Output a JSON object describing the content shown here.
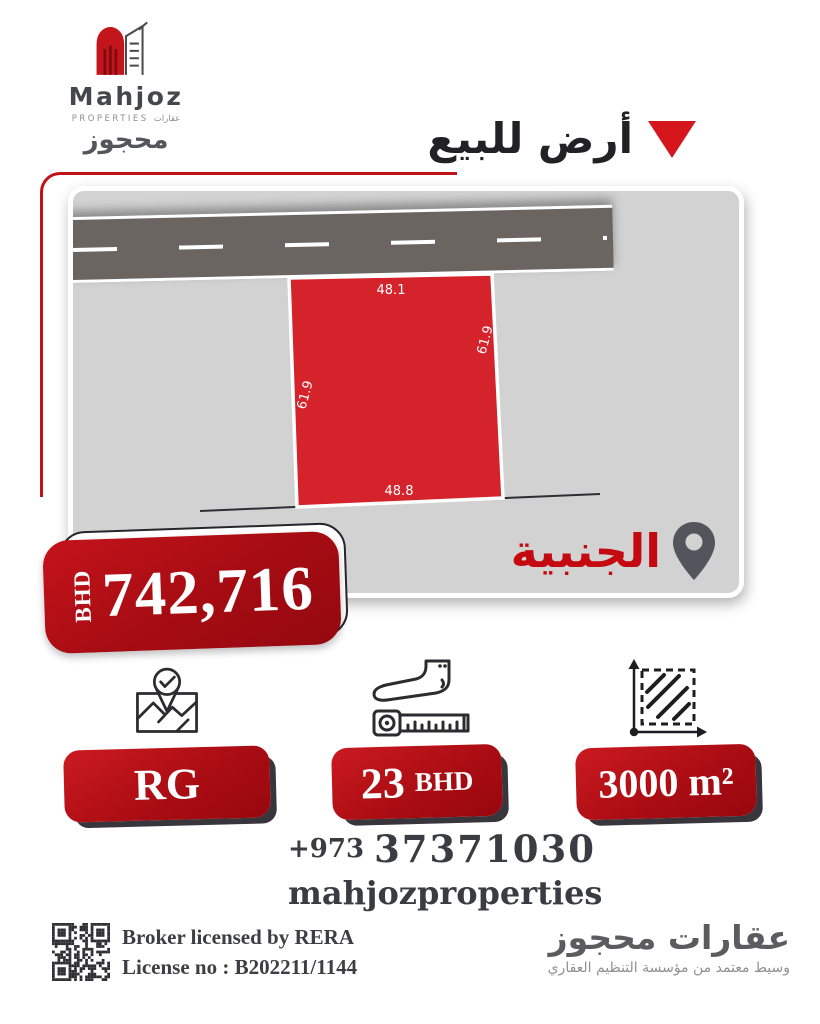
{
  "colors": {
    "accent_red": "#c1121a",
    "plot_red": "#d5232b",
    "badge_red": "#a80c12",
    "triangle_red": "#d5161d",
    "location_red": "#c40a10",
    "road_gray": "#6b6562",
    "card_gray": "#d2d2d2",
    "text_dark": "#3b3b42"
  },
  "logo": {
    "name": "Mahjoz",
    "sub_en": "PROPERTIES",
    "sub_ar": "عقارات",
    "arabic": "محجوز"
  },
  "title": {
    "text": "أرض للبيع"
  },
  "map": {
    "location": "الجنبية",
    "dimensions": {
      "top": "48.1",
      "bottom": "48.8",
      "left": "61.9",
      "right": "61.9"
    }
  },
  "price": {
    "currency": "BHD",
    "amount": "742,716"
  },
  "features": [
    {
      "icon": "map-check-icon",
      "label": "RG"
    },
    {
      "icon": "foot-measure-icon",
      "value": "23",
      "unit": "BHD"
    },
    {
      "icon": "area-icon",
      "label": "3000 m²"
    }
  ],
  "contact": {
    "phone_code": "+973",
    "phone_number": "37371030",
    "instagram": "mahjozproperties"
  },
  "footer": {
    "license_line1": "Broker licensed by RERA",
    "license_line2": "License no : B202211/1144",
    "brand_ar": "عقارات محجوز",
    "tagline_ar": "وسيط معتمد من مؤسسة التنظيم العقاري"
  }
}
